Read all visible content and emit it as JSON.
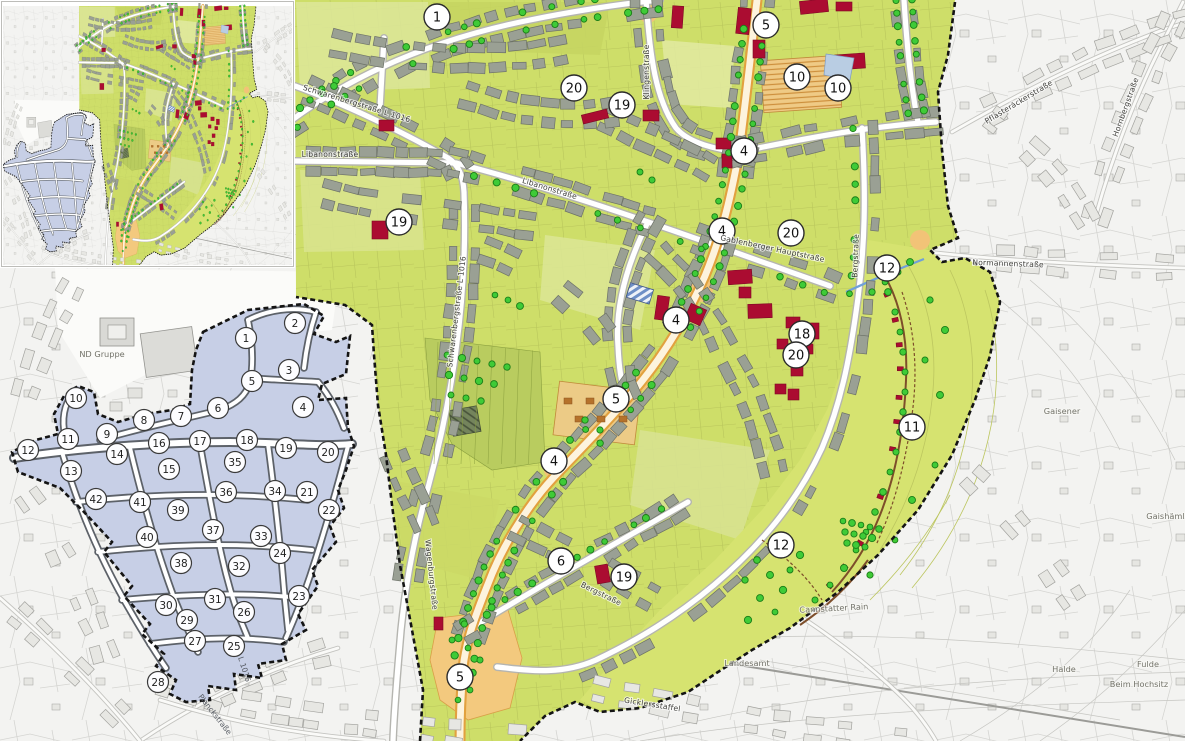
{
  "map_title": "Sanierungsgebiet Rahmenplan",
  "colors": {
    "plan_area_green": "#cede69",
    "hillside_green": "#d6e370",
    "building_gray": "#9aa094",
    "renewal_red": "#ab0c31",
    "street_orange": "#e2a13f",
    "plaza_orange": "#f3c97e",
    "tree_green": "#3fcb37",
    "block_zone_blue": "#c7cfe6",
    "boundary_black": "#141414",
    "cadastral_bg": "#f3f3f1",
    "water_blue": "#70a0d8"
  },
  "main_map": {
    "markers": [
      {
        "n": "1",
        "x": 437,
        "y": 17
      },
      {
        "n": "5",
        "x": 766,
        "y": 25
      },
      {
        "n": "20",
        "x": 574,
        "y": 88
      },
      {
        "n": "19",
        "x": 622,
        "y": 105
      },
      {
        "n": "10",
        "x": 797,
        "y": 77
      },
      {
        "n": "10",
        "x": 838,
        "y": 88
      },
      {
        "n": "4",
        "x": 744,
        "y": 151
      },
      {
        "n": "19",
        "x": 399,
        "y": 222
      },
      {
        "n": "4",
        "x": 722,
        "y": 231
      },
      {
        "n": "20",
        "x": 791,
        "y": 233
      },
      {
        "n": "12",
        "x": 887,
        "y": 268
      },
      {
        "n": "4",
        "x": 676,
        "y": 320
      },
      {
        "n": "18",
        "x": 802,
        "y": 334
      },
      {
        "n": "20",
        "x": 796,
        "y": 355
      },
      {
        "n": "5",
        "x": 616,
        "y": 399
      },
      {
        "n": "11",
        "x": 912,
        "y": 427
      },
      {
        "n": "4",
        "x": 554,
        "y": 461
      },
      {
        "n": "12",
        "x": 781,
        "y": 545
      },
      {
        "n": "6",
        "x": 561,
        "y": 561
      },
      {
        "n": "19",
        "x": 624,
        "y": 577
      },
      {
        "n": "5",
        "x": 460,
        "y": 677
      }
    ],
    "street_labels": [
      {
        "text": "Schwarenbergstraße  L 1016",
        "x": 356,
        "y": 106,
        "r": 17,
        "cls": "lbl-street"
      },
      {
        "text": "Libanonstraße",
        "x": 330,
        "y": 157,
        "r": 0,
        "cls": "lbl-street"
      },
      {
        "text": "Libanonstraße",
        "x": 549,
        "y": 191,
        "r": 17,
        "cls": "lbl-street"
      },
      {
        "text": "Klingenstraße",
        "x": 649,
        "y": 72,
        "r": -90,
        "cls": "lbl-street"
      },
      {
        "text": "Schwarenbergstraße  L 1016",
        "x": 459,
        "y": 312,
        "r": -83,
        "cls": "lbl-street"
      },
      {
        "text": "Gablenberger Hauptstraße",
        "x": 772,
        "y": 251,
        "r": 12,
        "cls": "lbl-street"
      },
      {
        "text": "Bergstraße",
        "x": 858,
        "y": 256,
        "r": -88,
        "cls": "lbl-street"
      },
      {
        "text": "Bergstraße",
        "x": 600,
        "y": 596,
        "r": 26,
        "cls": "lbl-street"
      },
      {
        "text": "Wagenburgstraße",
        "x": 429,
        "y": 575,
        "r": 84,
        "cls": "lbl-street"
      },
      {
        "text": "Normannenstraße",
        "x": 1008,
        "y": 266,
        "r": 2,
        "cls": "lbl-street"
      },
      {
        "text": "Pflasteräckerstraße",
        "x": 1020,
        "y": 104,
        "r": -31,
        "cls": "lbl-street"
      },
      {
        "text": "Hornbergstraße",
        "x": 1128,
        "y": 108,
        "r": -70,
        "cls": "lbl-street"
      },
      {
        "text": "Gicklersstaffel",
        "x": 652,
        "y": 707,
        "r": 9,
        "cls": "lbl-street"
      }
    ],
    "area_labels": [
      {
        "text": "ND Gruppe",
        "x": 102,
        "y": 357,
        "r": 0,
        "cls": "lbl-area"
      },
      {
        "text": "Cannstatter Rain",
        "x": 834,
        "y": 611,
        "r": -3,
        "cls": "lbl-area"
      },
      {
        "text": "Landesamt",
        "x": 747,
        "y": 666,
        "r": 0,
        "cls": "lbl-area"
      },
      {
        "text": "Gaisener",
        "x": 1062,
        "y": 414,
        "r": 0,
        "cls": "lbl-area"
      },
      {
        "text": "Gaishämle",
        "x": 1168,
        "y": 519,
        "r": 0,
        "cls": "lbl-area"
      },
      {
        "text": "Halde",
        "x": 1064,
        "y": 672,
        "r": 0,
        "cls": "lbl-area"
      },
      {
        "text": "Fulde",
        "x": 1148,
        "y": 667,
        "r": 0,
        "cls": "lbl-area"
      },
      {
        "text": "Beim Hochsitz",
        "x": 1139,
        "y": 687,
        "r": 0,
        "cls": "lbl-area"
      }
    ],
    "red_buildings": [
      [
        737,
        8,
        13,
        26,
        6
      ],
      [
        753,
        40,
        12,
        18,
        0
      ],
      [
        800,
        0,
        28,
        13,
        -6
      ],
      [
        836,
        2,
        16,
        9,
        0
      ],
      [
        835,
        54,
        30,
        15,
        -4
      ],
      [
        672,
        6,
        11,
        22,
        4
      ],
      [
        582,
        112,
        26,
        9,
        -14
      ],
      [
        643,
        110,
        16,
        11,
        0
      ],
      [
        379,
        120,
        15,
        11,
        0
      ],
      [
        372,
        221,
        16,
        18,
        0
      ],
      [
        716,
        138,
        15,
        11,
        0
      ],
      [
        722,
        154,
        10,
        14,
        0
      ],
      [
        728,
        270,
        24,
        14,
        -4
      ],
      [
        739,
        287,
        12,
        11,
        0
      ],
      [
        748,
        304,
        24,
        14,
        -2
      ],
      [
        786,
        317,
        14,
        11,
        0
      ],
      [
        807,
        323,
        12,
        16,
        0
      ],
      [
        777,
        339,
        11,
        10,
        0
      ],
      [
        801,
        344,
        12,
        10,
        0
      ],
      [
        791,
        365,
        12,
        11,
        0
      ],
      [
        775,
        384,
        11,
        10,
        0
      ],
      [
        788,
        389,
        11,
        11,
        0
      ],
      [
        656,
        296,
        12,
        24,
        8
      ],
      [
        687,
        306,
        17,
        17,
        24
      ],
      [
        596,
        565,
        13,
        18,
        -10
      ],
      [
        434,
        617,
        9,
        13,
        0
      ]
    ]
  },
  "blue_zone": {
    "markers": [
      {
        "n": "1",
        "x": 246,
        "y": 338
      },
      {
        "n": "2",
        "x": 295,
        "y": 323
      },
      {
        "n": "3",
        "x": 289,
        "y": 370
      },
      {
        "n": "4",
        "x": 303,
        "y": 407
      },
      {
        "n": "5",
        "x": 252,
        "y": 381
      },
      {
        "n": "6",
        "x": 218,
        "y": 408
      },
      {
        "n": "7",
        "x": 181,
        "y": 416
      },
      {
        "n": "8",
        "x": 144,
        "y": 420
      },
      {
        "n": "9",
        "x": 107,
        "y": 434
      },
      {
        "n": "10",
        "x": 76,
        "y": 398
      },
      {
        "n": "11",
        "x": 68,
        "y": 439
      },
      {
        "n": "12",
        "x": 28,
        "y": 450
      },
      {
        "n": "13",
        "x": 71,
        "y": 471
      },
      {
        "n": "14",
        "x": 117,
        "y": 454
      },
      {
        "n": "15",
        "x": 169,
        "y": 469
      },
      {
        "n": "16",
        "x": 159,
        "y": 443
      },
      {
        "n": "17",
        "x": 200,
        "y": 441
      },
      {
        "n": "18",
        "x": 247,
        "y": 440
      },
      {
        "n": "19",
        "x": 286,
        "y": 448
      },
      {
        "n": "20",
        "x": 328,
        "y": 452
      },
      {
        "n": "21",
        "x": 307,
        "y": 492
      },
      {
        "n": "22",
        "x": 329,
        "y": 510
      },
      {
        "n": "23",
        "x": 299,
        "y": 596
      },
      {
        "n": "24",
        "x": 280,
        "y": 553
      },
      {
        "n": "25",
        "x": 234,
        "y": 646
      },
      {
        "n": "26",
        "x": 244,
        "y": 612
      },
      {
        "n": "27",
        "x": 195,
        "y": 641
      },
      {
        "n": "28",
        "x": 158,
        "y": 682
      },
      {
        "n": "29",
        "x": 187,
        "y": 620
      },
      {
        "n": "30",
        "x": 166,
        "y": 605
      },
      {
        "n": "31",
        "x": 215,
        "y": 599
      },
      {
        "n": "32",
        "x": 239,
        "y": 566
      },
      {
        "n": "33",
        "x": 261,
        "y": 536
      },
      {
        "n": "34",
        "x": 275,
        "y": 491
      },
      {
        "n": "35",
        "x": 235,
        "y": 462
      },
      {
        "n": "36",
        "x": 226,
        "y": 492
      },
      {
        "n": "37",
        "x": 213,
        "y": 530
      },
      {
        "n": "38",
        "x": 181,
        "y": 563
      },
      {
        "n": "39",
        "x": 178,
        "y": 510
      },
      {
        "n": "40",
        "x": 147,
        "y": 537
      },
      {
        "n": "41",
        "x": 140,
        "y": 502
      },
      {
        "n": "42",
        "x": 96,
        "y": 499
      }
    ],
    "labels": [
      {
        "text": "Planckstraße",
        "x": 213,
        "y": 716,
        "r": 52,
        "cls": "lbl-blue"
      },
      {
        "text": "L 1016",
        "x": 242,
        "y": 670,
        "r": 72,
        "cls": "lbl-blue"
      }
    ]
  }
}
